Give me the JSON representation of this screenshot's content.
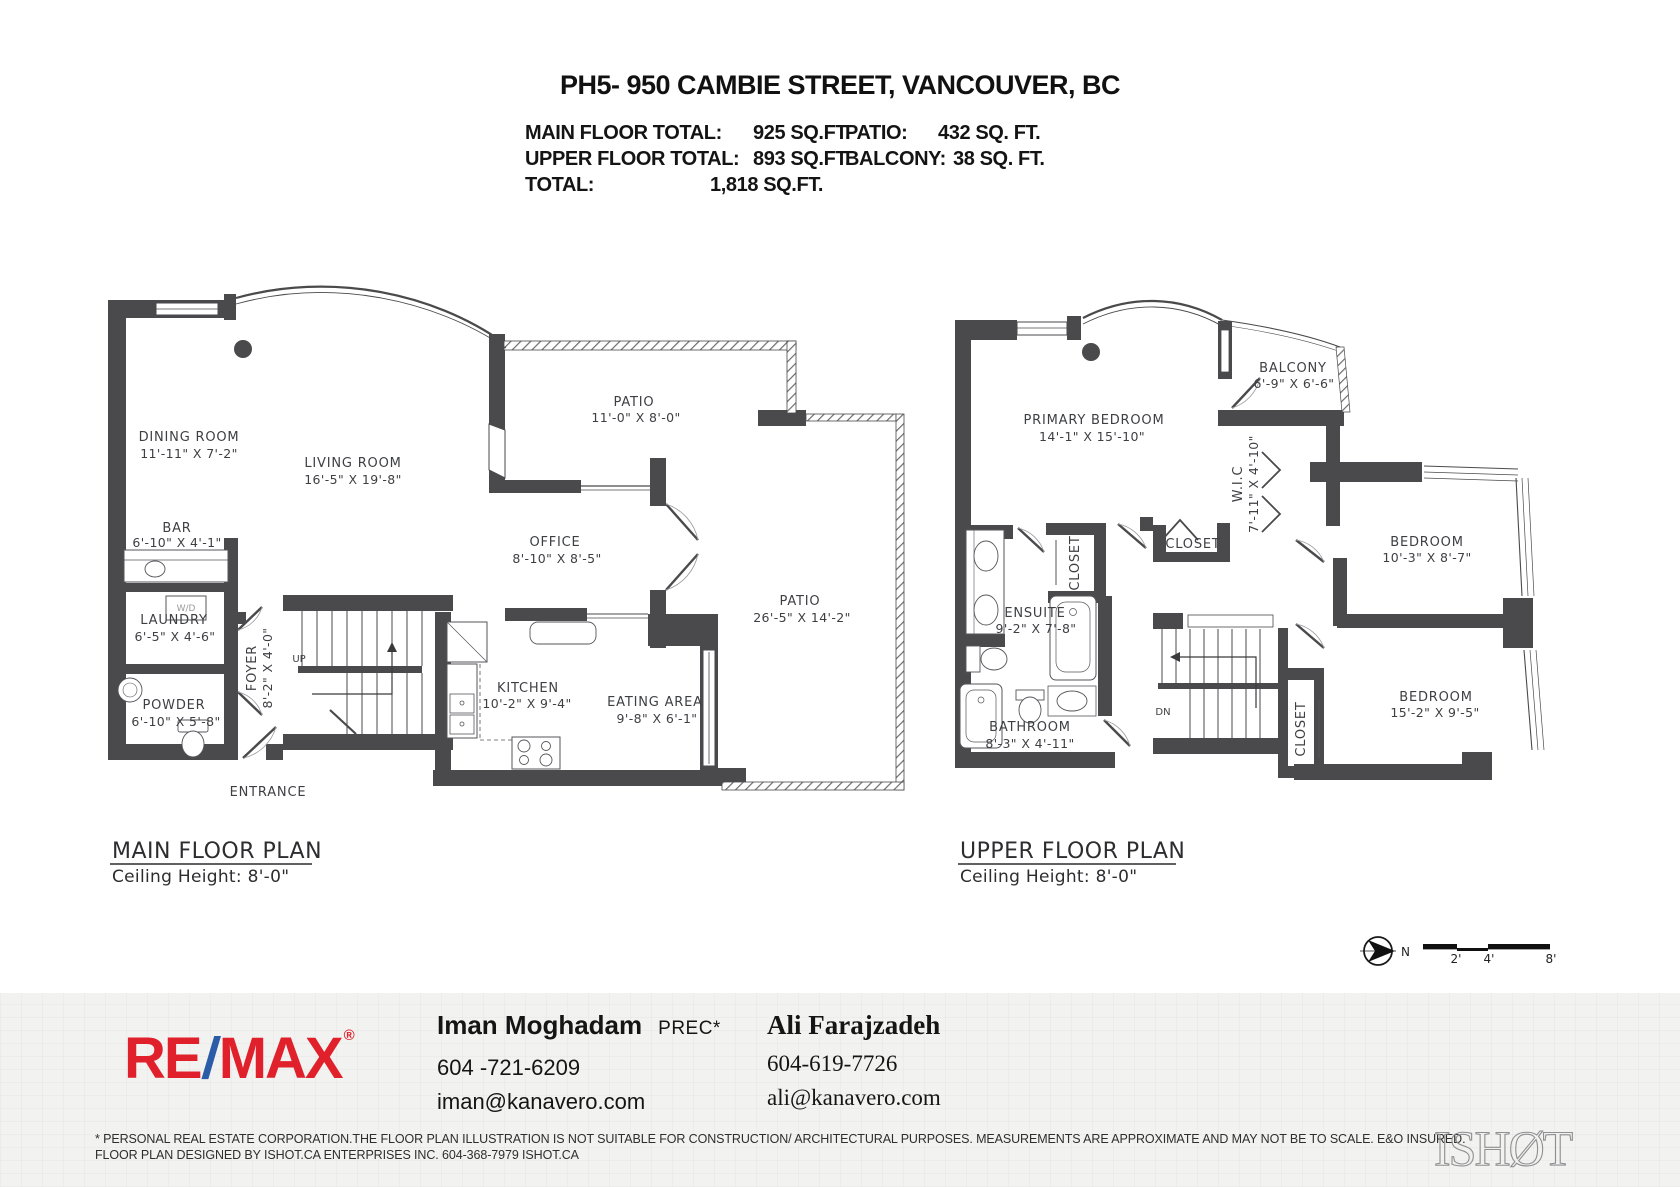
{
  "header": {
    "title": "PH5- 950 CAMBIE STREET, VANCOUVER, BC",
    "totals": {
      "main_label": "MAIN FLOOR TOTAL:",
      "main_value": "925 SQ.FT.",
      "upper_label": "UPPER FLOOR TOTAL:",
      "upper_value": "893 SQ.FT.",
      "total_label": "TOTAL:",
      "total_value": "1,818 SQ.FT.",
      "patio_label": "PATIO:",
      "patio_value": "432 SQ. FT.",
      "balcony_label": "BALCONY:",
      "balcony_value": "38 SQ. FT."
    }
  },
  "main_floor": {
    "plan_title": "MAIN FLOOR PLAN",
    "ceiling": "Ceiling Height: 8'-0\"",
    "rooms": {
      "dining": {
        "name": "DINING ROOM",
        "dims": "11'-11\" X 7'-2\""
      },
      "living": {
        "name": "LIVING ROOM",
        "dims": "16'-5\" X 19'-8\""
      },
      "patio_top": {
        "name": "PATIO",
        "dims": "11'-0\" X 8'-0\""
      },
      "office": {
        "name": "OFFICE",
        "dims": "8'-10\" X 8'-5\""
      },
      "patio_right": {
        "name": "PATIO",
        "dims": "26'-5\" X 14'-2\""
      },
      "bar": {
        "name": "BAR",
        "dims": "6'-10\" X 4'-1\""
      },
      "laundry": {
        "name": "LAUNDRY",
        "dims": "6'-5\" X 4'-6\""
      },
      "powder": {
        "name": "POWDER",
        "dims": "6'-10\" X 5'-8\""
      },
      "foyer": {
        "name": "FOYER",
        "dims": "8'-2\" X 4'-0\""
      },
      "kitchen": {
        "name": "KITCHEN",
        "dims": "10'-2\" X 9'-4\""
      },
      "eating": {
        "name": "EATING AREA",
        "dims": "9'-8\" X 6'-1\""
      }
    },
    "labels": {
      "entrance": "ENTRANCE",
      "up": "UP",
      "wd": "W/D"
    }
  },
  "upper_floor": {
    "plan_title": "UPPER FLOOR PLAN",
    "ceiling": "Ceiling Height: 8'-0\"",
    "rooms": {
      "primary": {
        "name": "PRIMARY BEDROOM",
        "dims": "14'-1\" X 15'-10\""
      },
      "balcony": {
        "name": "BALCONY",
        "dims": "6'-9\" X 6'-6\""
      },
      "wic": {
        "name": "W.I.C",
        "dims": "7'-11\" X 4'-10\""
      },
      "closet_primary": {
        "name": "CLOSET"
      },
      "closet_ensuite": {
        "name": "CLOSET"
      },
      "closet_hall": {
        "name": "CLOSET"
      },
      "bedroom1": {
        "name": "BEDROOM",
        "dims": "10'-3\" X 8'-7\""
      },
      "bedroom2": {
        "name": "BEDROOM",
        "dims": "15'-2\" X 9'-5\""
      },
      "ensuite": {
        "name": "ENSUITE",
        "dims": "9'-2\" X 7'-8\""
      },
      "bathroom": {
        "name": "BATHROOM",
        "dims": "8'-3\" X 4'-11\""
      }
    },
    "labels": {
      "dn": "DN"
    }
  },
  "compass": {
    "north": "N"
  },
  "scale_bar": {
    "ticks": [
      "2'",
      "4'",
      "8'"
    ]
  },
  "footer": {
    "brand": {
      "re": "RE",
      "slash": "/",
      "max": "MAX",
      "reg": "®"
    },
    "agents": [
      {
        "name": "Iman Moghadam",
        "designation": "PREC*",
        "phone": "604 -721-6209",
        "email": "iman@kanavero.com"
      },
      {
        "name": "Ali Farajzadeh",
        "phone": "604-619-7726",
        "email": "ali@kanavero.com"
      }
    ],
    "disclaimer_line1": "* PERSONAL REAL ESTATE CORPORATION.THE FLOOR PLAN ILLUSTRATION IS NOT SUITABLE FOR CONSTRUCTION/ ARCHITECTURAL PURPOSES. MEASUREMENTS ARE APPROXIMATE AND MAY NOT BE TO SCALE. E&O INSURED.",
    "disclaimer_line2": "FLOOR PLAN DESIGNED BY ISHOT.CA ENTERPRISES INC. 604-368-7979  ISHOT.CA",
    "studio_logo": "ISHØT"
  },
  "colors": {
    "wall": "#4a4a4c",
    "accent_red": "#e0202a",
    "accent_blue": "#2b5ca8",
    "footer_bg": "#f2f2f1"
  }
}
